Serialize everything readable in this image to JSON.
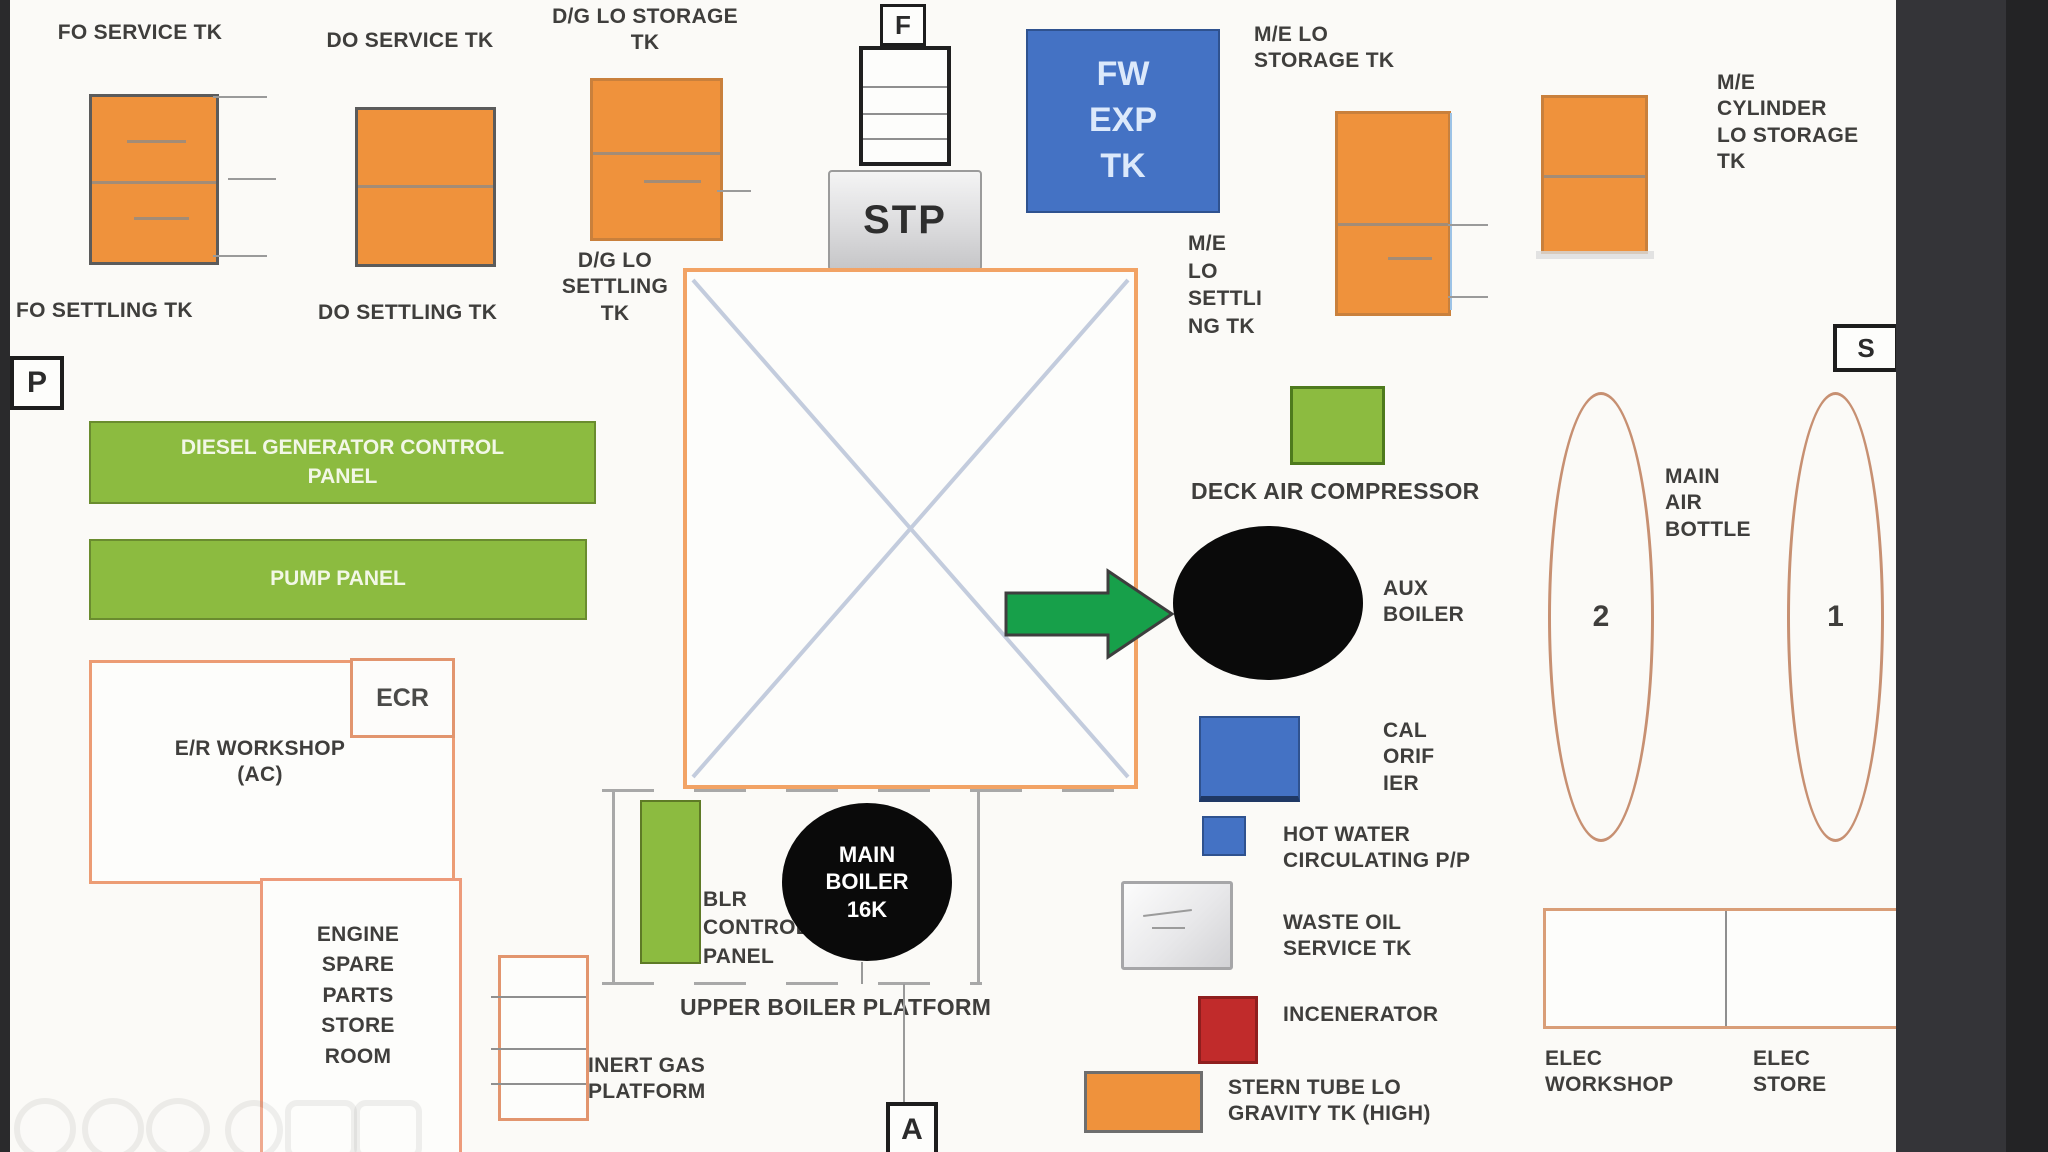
{
  "diagram_title": "Engine room deck layout",
  "colors": {
    "tank_orange": "#EF923C",
    "panel_green": "#8CBB40",
    "tank_blue": "#4472C4",
    "arrow_green": "#17A04A",
    "incinerator_red": "#C12B2B",
    "boiler_black": "#0A0A0A",
    "outline_orange": "#F2A365",
    "room_border_salmon": "#ED9B7B",
    "air_bottle_tan": "#C79072",
    "side_bar_dark": "#343438"
  },
  "markers": {
    "forward": "F",
    "port": "P",
    "starboard": "S",
    "aft": "A"
  },
  "labels": {
    "fo_service_tk": "FO SERVICE TK",
    "do_service_tk": "DO SERVICE TK",
    "dg_lo_storage_tk": "D/G LO STORAGE\nTK",
    "fo_settling_tk": "FO SETTLING TK",
    "do_settling_tk": "DO SETTLING TK",
    "dg_lo_settling_tk": "D/G LO\nSETTLING\nTK",
    "me_lo_storage_tk": "M/E LO\nSTORAGE TK",
    "me_cylinder_lo_storage_tk": "M/E\nCYLINDER\nLO STORAGE\nTK",
    "me_lo_settling_tk": "M/E\nLO\nSETTLI\nNG TK",
    "fw_exp_tk": "FW\nEXP\nTK",
    "stp": "STP",
    "diesel_generator_control_panel": "DIESEL GENERATOR CONTROL\nPANEL",
    "pump_panel": "PUMP PANEL",
    "deck_air_compressor": "DECK AIR COMPRESSOR",
    "aux_boiler": "AUX\nBOILER",
    "main_air_bottle": "MAIN\nAIR\nBOTTLE",
    "air_bottle_2": "2",
    "air_bottle_1": "1",
    "calorifier": "CAL\nORIF\nIER",
    "hot_water_circulating_pp": "HOT WATER\nCIRCULATING P/P",
    "waste_oil_service_tk": "WASTE OIL\nSERVICE TK",
    "incenerator": "INCENERATOR",
    "stern_tube_lo_gravity_tk": "STERN TUBE LO\nGRAVITY TK (HIGH)",
    "ecr": "ECR",
    "er_workshop_ac": "E/R WORKSHOP\n(AC)",
    "engine_spare_parts_store_room": "ENGINE\nSPARE\nPARTS\nSTORE\nROOM",
    "inert_gas_platform": "INERT GAS\nPLATFORM",
    "blr_control_panel": "BLR\nCONTROL\nPANEL",
    "main_boiler_16k": "MAIN\nBOILER\n16K",
    "upper_boiler_platform": "UPPER BOILER PLATFORM",
    "elec_workshop": "ELEC\nWORKSHOP",
    "elec_store": "ELEC\nSTORE"
  }
}
